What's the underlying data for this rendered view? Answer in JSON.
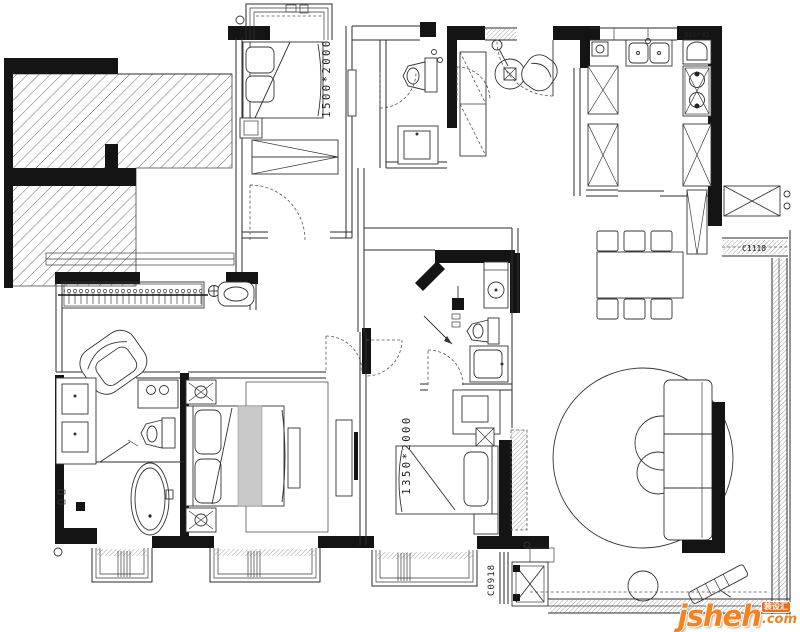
{
  "meta": {
    "type": "residential floor plan drawing",
    "background": "#ffffff",
    "line_color": "#141414"
  },
  "labels": {
    "bedroom2_bed_size": "1500*2000",
    "bedroom3_bed_size": "1350*2000",
    "window_code_bottom": "C0918",
    "window_code_right": "C1118",
    "kitchen_counter_dim": "600*45"
  },
  "watermark": {
    "brand": "jsheh",
    "suffix": ".com",
    "badge": "装设汇",
    "brand_color": "#f5821f",
    "badge_color": "#ee6c15"
  }
}
